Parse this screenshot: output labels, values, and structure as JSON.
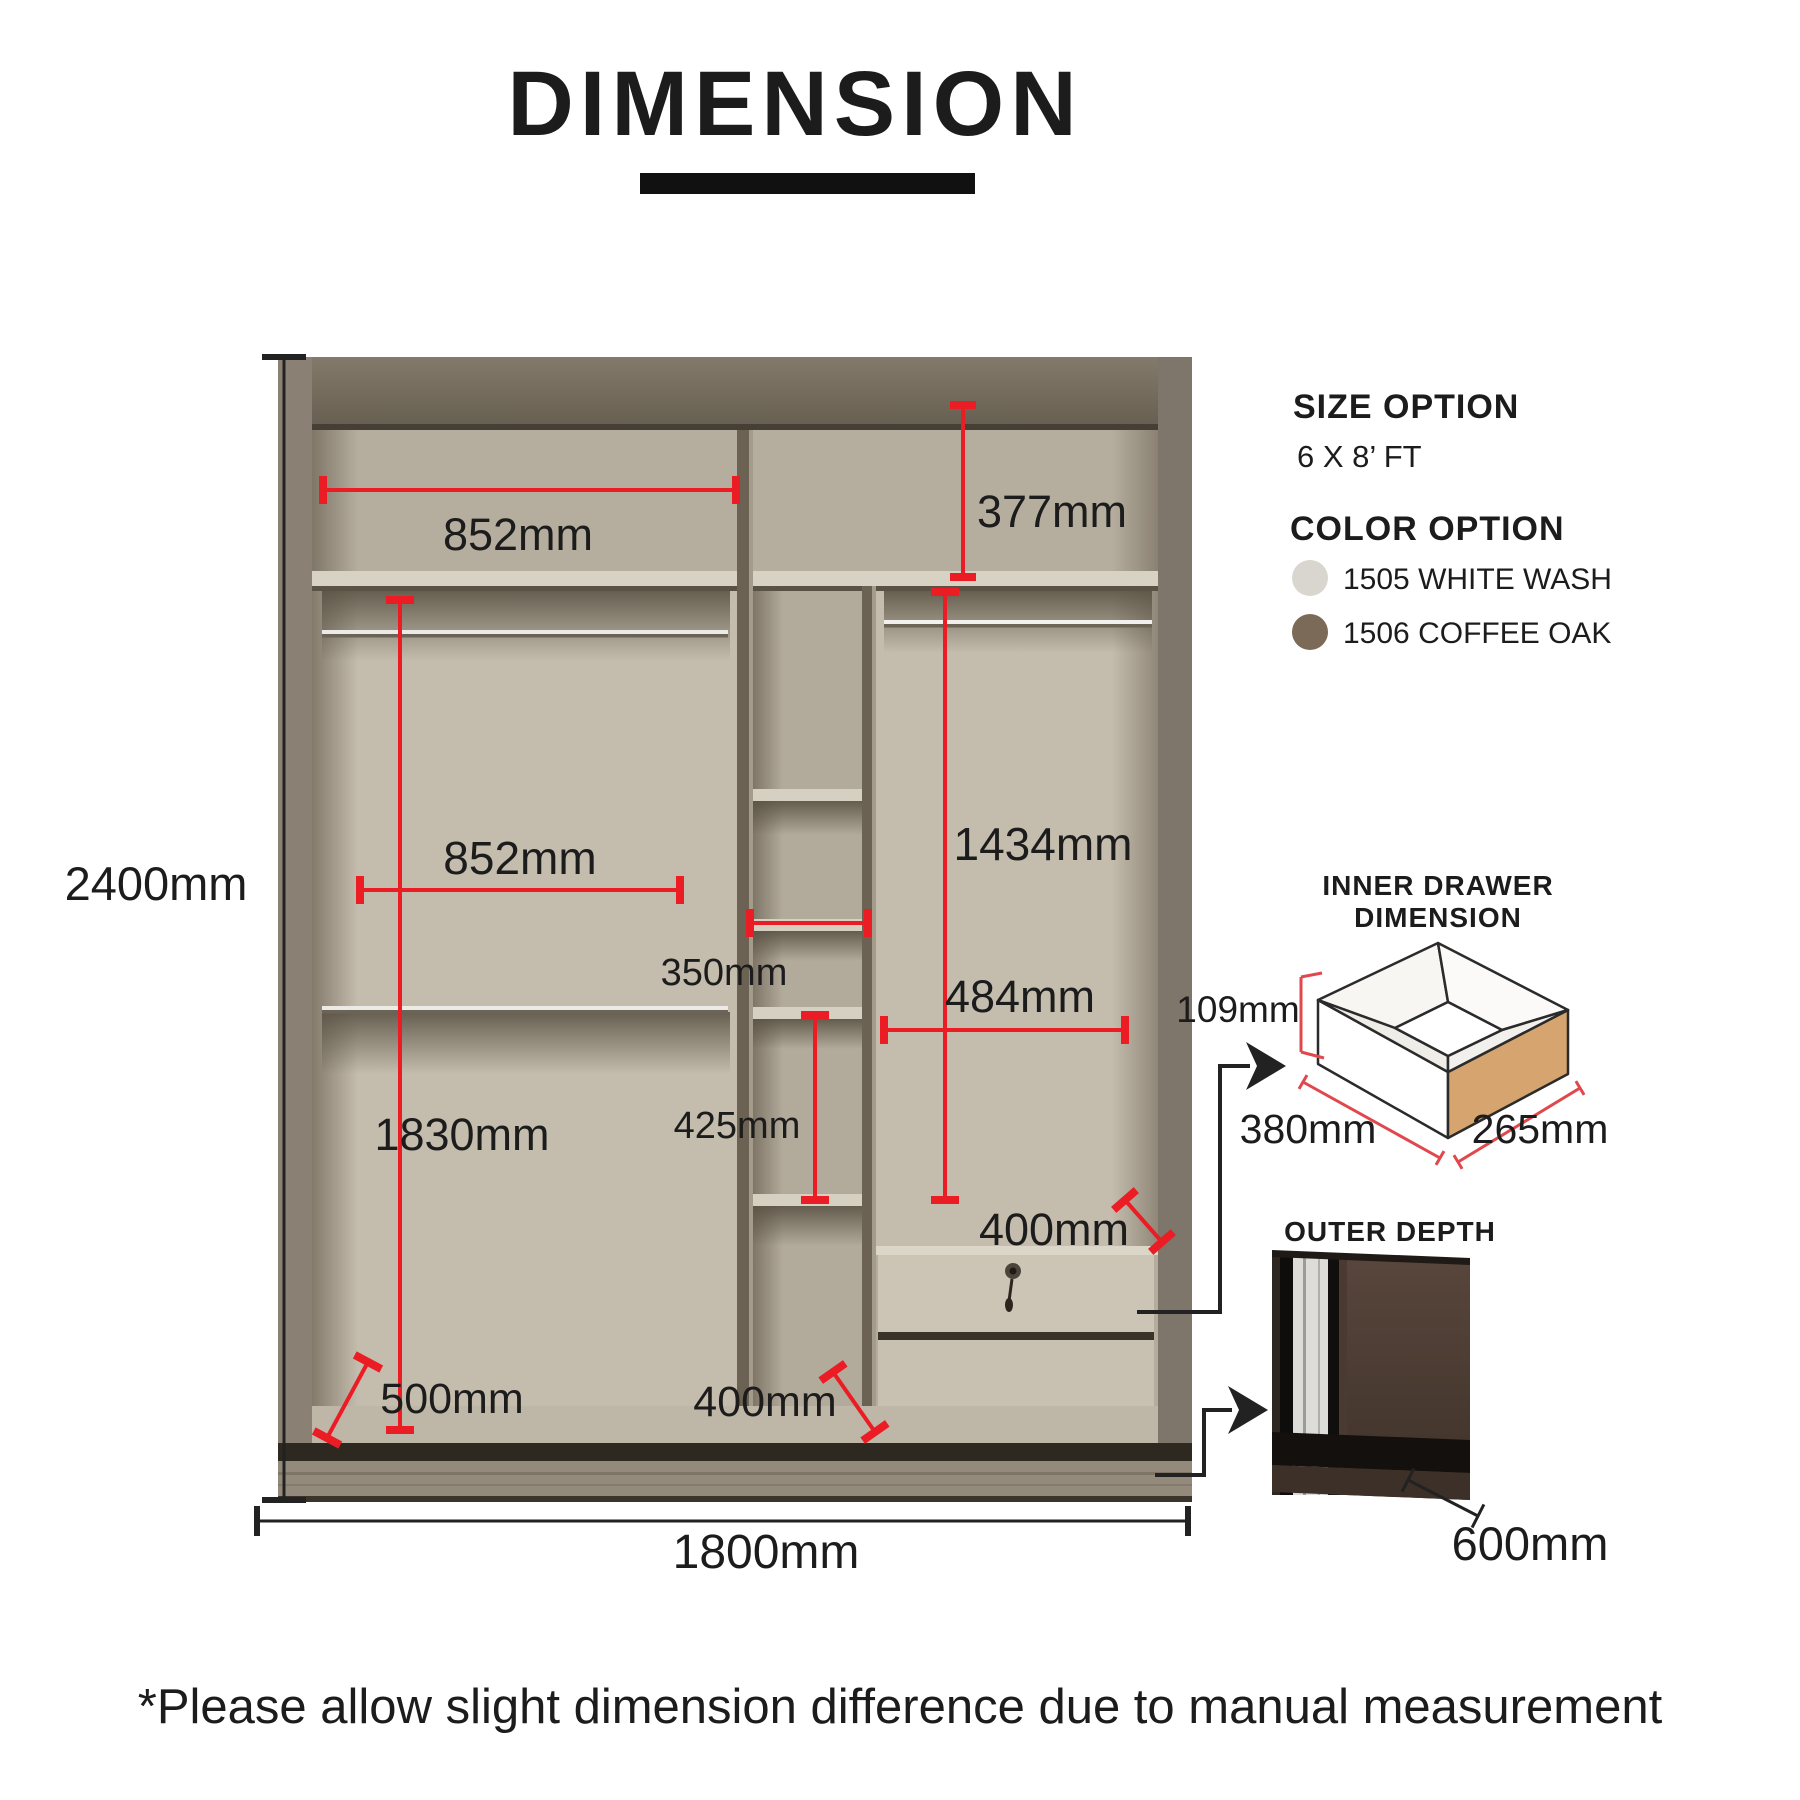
{
  "title": "DIMENSION",
  "panel": {
    "size_option_heading": "SIZE OPTION",
    "size_option_value": "6 X 8’ FT",
    "color_option_heading": "COLOR OPTION",
    "colors": [
      {
        "label": "1505 WHITE WASH",
        "hex": "#d9d6d0"
      },
      {
        "label": "1506 COFFEE OAK",
        "hex": "#7c6a58"
      }
    ]
  },
  "dimensions": {
    "overall_height": "2400mm",
    "overall_width": "1800mm",
    "top_shelf_width": "852mm",
    "top_right_shelf_height": "377mm",
    "left_section_width": "852mm",
    "cubby_width": "350mm",
    "right_hanging_height": "1434mm",
    "right_section_width": "484mm",
    "cubby_height": "425mm",
    "left_hanging_height": "1830mm",
    "left_depth": "500mm",
    "bottom_cubby_depth": "400mm",
    "drawer_section_width": "400mm"
  },
  "inner_drawer": {
    "heading_line1": "INNER DRAWER",
    "heading_line2": "DIMENSION",
    "height": "109mm",
    "width": "380mm",
    "depth": "265mm"
  },
  "outer_depth": {
    "heading": "OUTER DEPTH",
    "value": "600mm"
  },
  "footnote": "*Please allow slight dimension difference due to manual measurement",
  "accent_color": "#ec1c24"
}
